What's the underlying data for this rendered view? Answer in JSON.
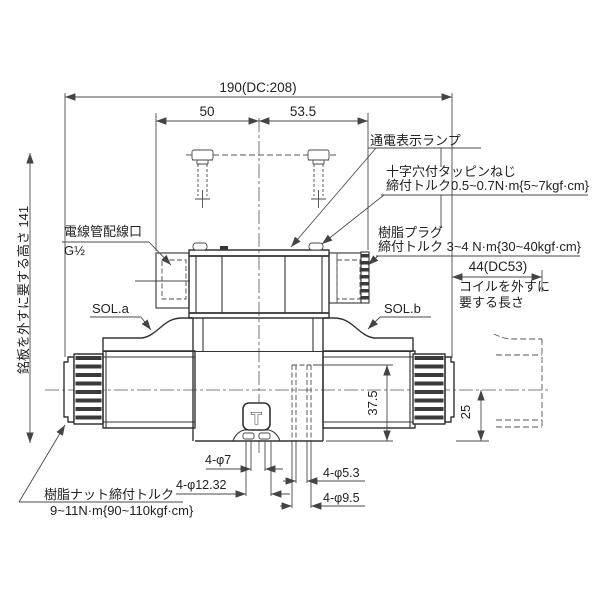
{
  "drawing_type": "solenoid-valve-outline-drawing",
  "colors": {
    "background": "#ffffff",
    "outline": "#333333",
    "thin_line": "#4a4a4a",
    "text": "#222222"
  },
  "labels": {
    "lamp": "通電表示ランプ",
    "tapping_screw_1": "十字穴付タッピンねじ",
    "tapping_screw_2": "締付トルク0.5~0.7N·m{5~7kgf·cm}",
    "resin_plug_1": "樹脂プラグ",
    "resin_plug_2": "締付トルク 3~4 N·m{30~40kgf·cm}",
    "conduit_1": "電線管配線口",
    "conduit_2": "G½",
    "sol_a": "SOL.a",
    "sol_b": "SOL.b",
    "coil_removal_1": "コイルを外すに",
    "coil_removal_2": "要する長さ",
    "resin_nut_1": "樹脂ナット締付トルク",
    "resin_nut_2": "9~11N·m{90~110kgf·cm}",
    "nameplate_height": "銘板を外すに要する高さ 141"
  },
  "dimensions": {
    "total_width": "190(DC:208)",
    "left_offset": "50",
    "right_offset": "53.5",
    "coil_removal_length": "44(DC53)",
    "hole_height": "37.5",
    "under_clearance": "25",
    "t_port_hole": "4-φ7",
    "t_port_spotface": "4-φ12.32",
    "mount_hole": "4-φ5.3",
    "mount_spotface": "4-φ9.5"
  },
  "marks": {
    "t_port": "T"
  }
}
